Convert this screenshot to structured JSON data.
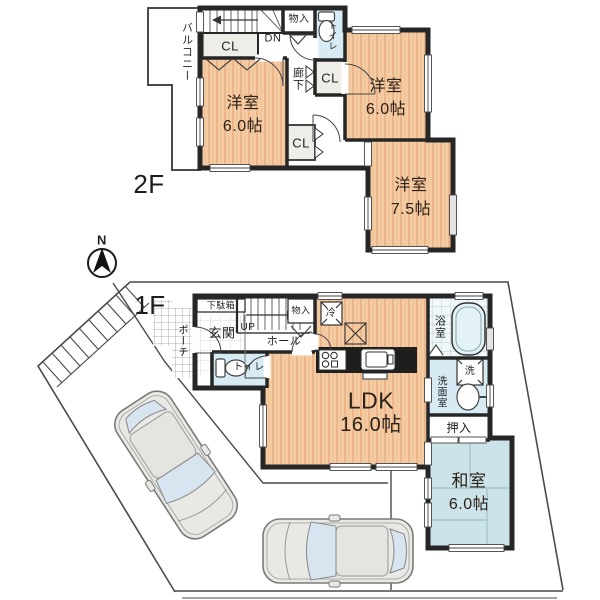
{
  "title": "house-floor-plan",
  "palette": {
    "wood": "#F5CBA2",
    "wood_stripe": "#E5AC80",
    "tatami": "#CBE3E9",
    "tatami_line": "#9FC2CD",
    "wet_room": "#D7EBF4",
    "tile_line": "#B8D3DC",
    "wall": "#262626",
    "closet_fill": "#EFEDE8",
    "glass": "#D8E4EF",
    "car_body": "#E8E8E4",
    "site_line": "#4a4a4a",
    "counter": "#1e1e1e"
  },
  "floor2": {
    "label": "2F",
    "balcony": "バルコニー",
    "stairs_down": "DN",
    "closet": "CL",
    "storage": "物入",
    "toilet": "トイレ",
    "hallway": "廊下",
    "rooms": {
      "west": {
        "name": "洋室",
        "size": "6.0帖"
      },
      "northeast": {
        "name": "洋室",
        "size": "6.0帖"
      },
      "southeast": {
        "name": "洋室",
        "size": "7.5帖"
      }
    }
  },
  "floor1": {
    "label": "1F",
    "compass_north": "N",
    "porch": "ポーチ",
    "shoe_cabinet": "下駄箱",
    "entrance": "玄関",
    "stairs_up": "UP",
    "hall": "ホール",
    "storage": "物入",
    "refrigerator": "冷",
    "toilet": "トイレ",
    "ldk": {
      "name": "LDK",
      "size": "16.0帖"
    },
    "bathroom": "浴室",
    "washer": "洗",
    "washroom": "洗面室",
    "closet": "押入",
    "japanese_room": {
      "name": "和室",
      "size": "6.0帖"
    }
  }
}
